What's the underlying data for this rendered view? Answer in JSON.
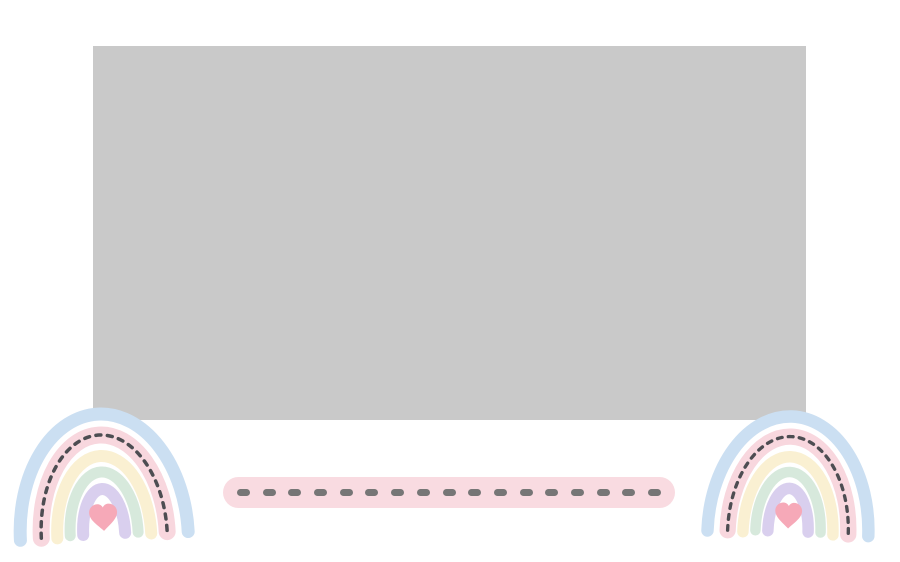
{
  "page": {
    "background_color": "#ffffff",
    "description": "Pastel boho rainbow frame template with gray image placeholder and dashed pink divider bar"
  },
  "image_placeholder": {
    "color": "#c9c9c9"
  },
  "text_placeholder_bar": {
    "background_color": "#f9dbe1",
    "dash_color": "#767676",
    "dash_count": 17
  },
  "rainbows": {
    "arc_names": [
      "blue",
      "pink",
      "cream",
      "mint",
      "lavender"
    ],
    "arc_colors": [
      "#cbdff2",
      "#f8d7de",
      "#faf0d2",
      "#d7e9dc",
      "#d9cfee"
    ],
    "stitch_color": "#4d4d52",
    "heart_color": "#f6a9b8",
    "positions": [
      "bottom-left",
      "bottom-right"
    ]
  }
}
